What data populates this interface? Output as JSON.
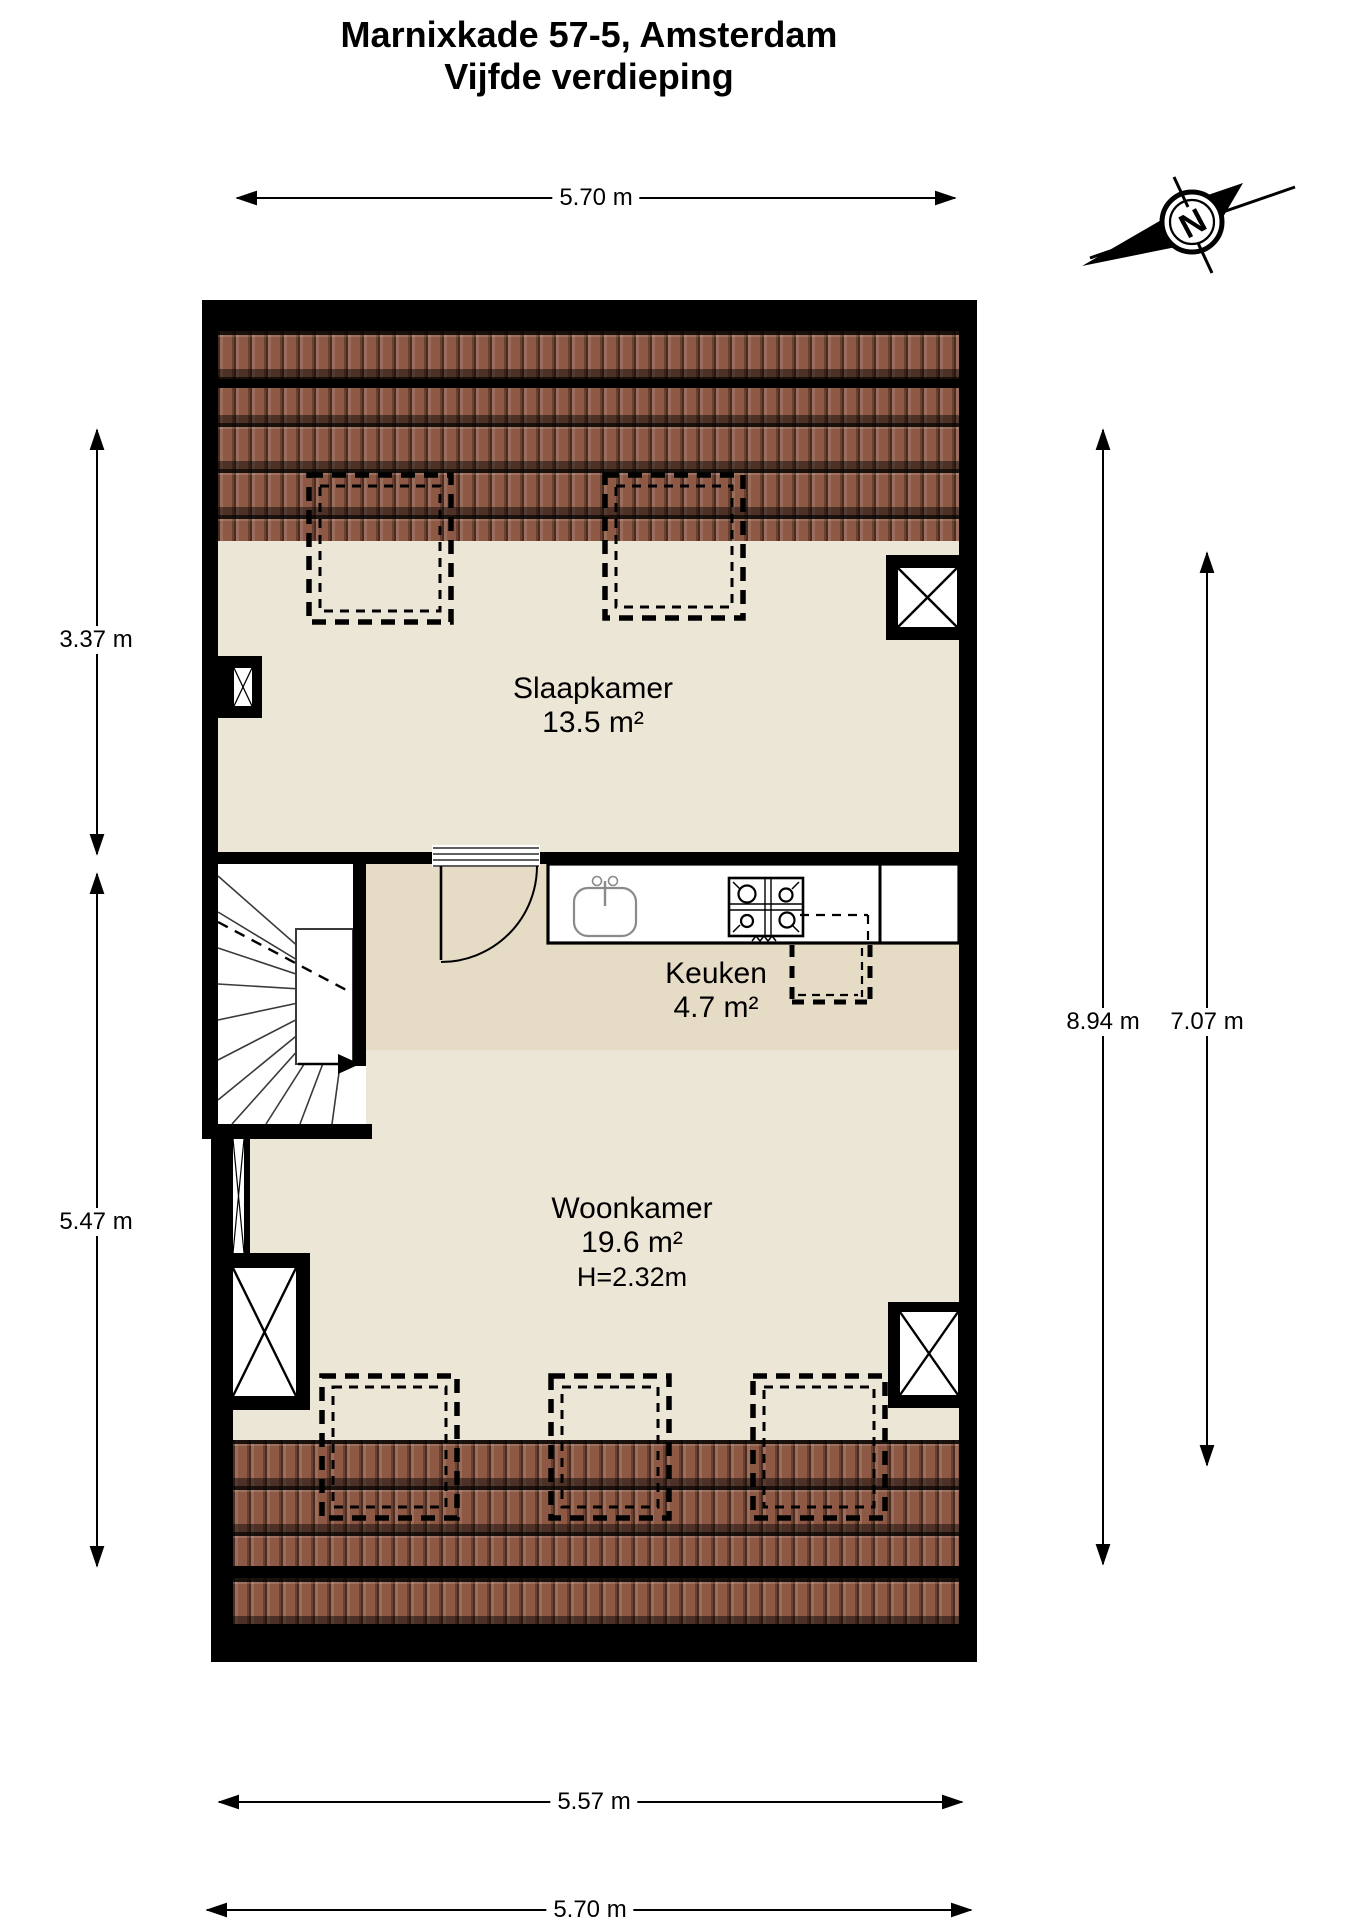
{
  "title": {
    "line1": "Marnixkade 57-5, Amsterdam",
    "line2": "Vijfde verdieping"
  },
  "compass": {
    "letter": "N"
  },
  "dimensions": {
    "top_width": "5.70 m",
    "left_upper": "3.37 m",
    "left_lower": "5.47 m",
    "right_outer": "8.94 m",
    "right_inner": "7.07 m",
    "bottom_inner": "5.57 m",
    "bottom_outer": "5.70 m"
  },
  "rooms": {
    "slaapkamer": {
      "name": "Slaapkamer",
      "area": "13.5 m²"
    },
    "keuken": {
      "name": "Keuken",
      "area": "4.7 m²"
    },
    "woonkamer": {
      "name": "Woonkamer",
      "area": "19.6 m²",
      "ceiling_height": "H=2.32m"
    }
  },
  "colors": {
    "wall": "#000000",
    "room_floor": "#ece6d7",
    "hall_floor": "#e6dcc6",
    "tile_base": "#8d5945",
    "fixture_stroke": "#8a8a8a"
  }
}
